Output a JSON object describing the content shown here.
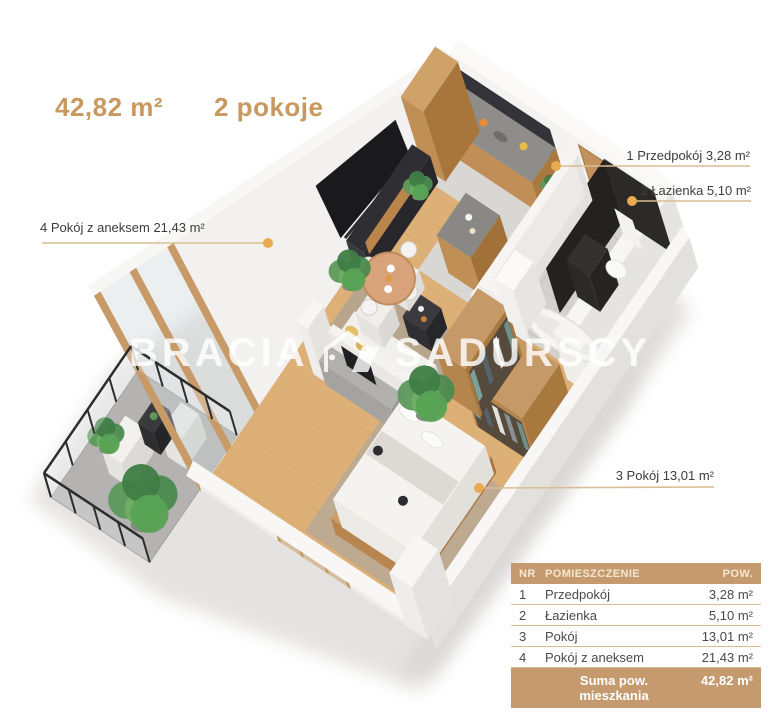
{
  "header": {
    "area": "42,82 m²",
    "rooms": "2 pokoje"
  },
  "watermark": {
    "part1": "BRACIA",
    "part2": "SADURSCY",
    "logo_icon": "roof-logo-icon"
  },
  "labels": [
    {
      "id": 1,
      "text": "1 Przedpokój 3,28 m²"
    },
    {
      "id": 2,
      "text": "2 Łazienka 5,10 m²"
    },
    {
      "id": 3,
      "text": "3 Pokój 13,01 m²"
    },
    {
      "id": 4,
      "text": "4 Pokój z aneksem 21,43 m²"
    }
  ],
  "table": {
    "headers": [
      "NR",
      "POMIESZCZENIE",
      "POW."
    ],
    "rows": [
      [
        "1",
        "Przedpokój",
        "3,28 m²"
      ],
      [
        "2",
        "Łazienka",
        "5,10 m²"
      ],
      [
        "3",
        "Pokój",
        "13,01 m²"
      ],
      [
        "4",
        "Pokój z aneksem",
        "21,43 m²"
      ]
    ],
    "footer": {
      "label": "Suma pow. mieszkania",
      "value": "42,82 m²"
    }
  },
  "colors": {
    "accent": "#c8995f",
    "table_header_bg": "#c49a6e",
    "table_line": "#d9bb94",
    "label_text": "#3d3d3d",
    "leader_line": "#d9bd94",
    "leader_dot": "#e9a94f",
    "wood_floor": "#ddb078",
    "dark_cabinet": "#34333a",
    "wood_cabinet": "#bf8f55"
  }
}
